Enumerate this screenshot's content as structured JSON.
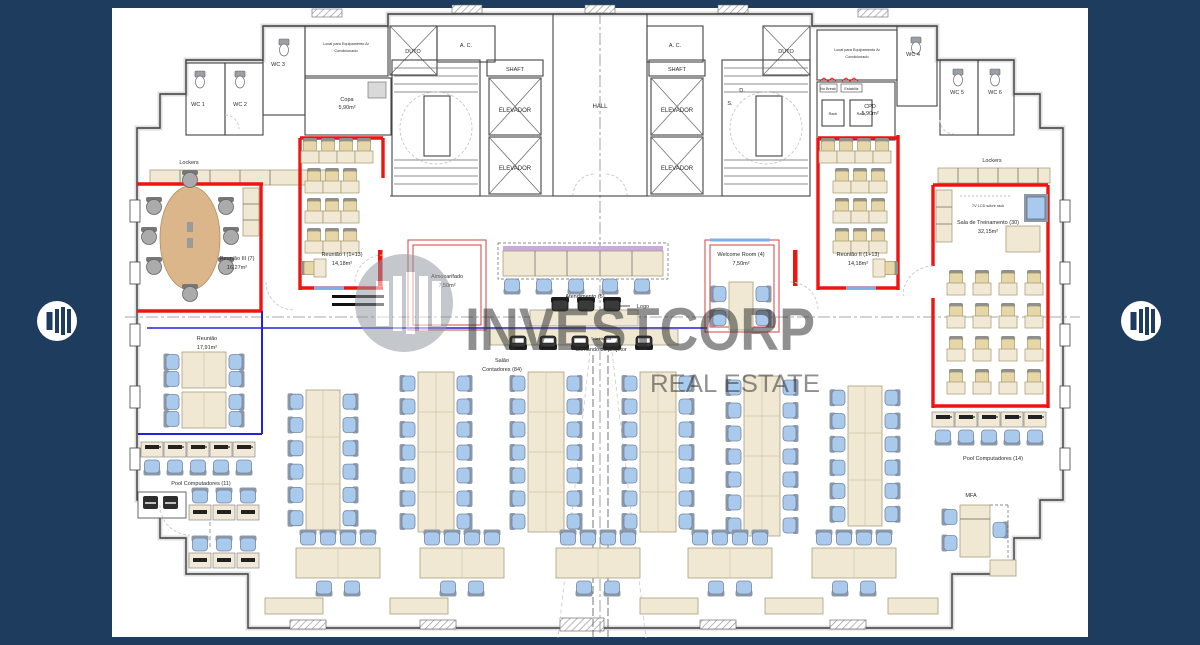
{
  "palette": {
    "frame_navy": "#1d3c5e",
    "wall_red": "#ee1511",
    "partition_red": "#d9534f",
    "glass_blue": "#2222dd",
    "door_blue": "#7ab0e8",
    "chair_blue": "#a9c9ed",
    "wc_green": "#cfe0cb",
    "equipment_gray": "#d4d4d4",
    "furniture_beige": "#f0e8d3",
    "hall_beige": "#ece1cf",
    "watermark_gray": "#8f97a1"
  },
  "watermark": {
    "title": "INVESTCORP",
    "subtitle": "REAL ESTATE"
  },
  "core": {
    "hall": "HALL",
    "shaft": "SHAFT",
    "elevator": "ELEVADOR",
    "duto": "DUTO",
    "ac": "A. C.",
    "stair_up": "S.",
    "stair_down": "D."
  },
  "rooms": {
    "wc1": "WC 1",
    "wc2": "WC 2",
    "wc3": "WC 3",
    "wc4": "WC 4",
    "wc5": "WC 5",
    "wc6": "WC 6",
    "local_ac_l1": "Local para Equipamento Ar",
    "local_ac_l2": "Condicionado",
    "copa_name": "Copa",
    "copa_area": "5,90m²",
    "cpd_name": "CPD",
    "cpd_area": "5,90m²",
    "rack": "Rack",
    "nobreak": "No Break",
    "estabiliz": "Estabiliz.",
    "lockers": "Lockers",
    "reuniao3_name": "Reunião III (7)",
    "reuniao3_area": "16,27m²",
    "reuniao1_name": "Reunião I (1+13)",
    "reuniao1_area": "14,18m²",
    "reuniao2_name": "Reunião II (1+13)",
    "reuniao2_area": "14,18m²",
    "reuniao_name": "Reunião",
    "reuniao_area": "17,91m²",
    "almoxarifado_name": "Almoxarifado",
    "almoxarifado_area": "7,50m²",
    "atendimento": "Atendimento (5)",
    "logo": "Logo",
    "salao_name": "Salão",
    "salao_area": "Contadores (84)",
    "tela": "Tela elétrica",
    "projetor": "Comando do projetor",
    "welcome_name": "Welcome Room (4)",
    "welcome_area": "7,50m²",
    "treinamento_name": "Sala de Treinamento (30)",
    "treinamento_area": "32,15m²",
    "tv": "TV LCD sobre rack",
    "pool11": "Pool Computadores (11)",
    "pool14": "Pool Computadores (14)",
    "mfa": "MFA"
  }
}
